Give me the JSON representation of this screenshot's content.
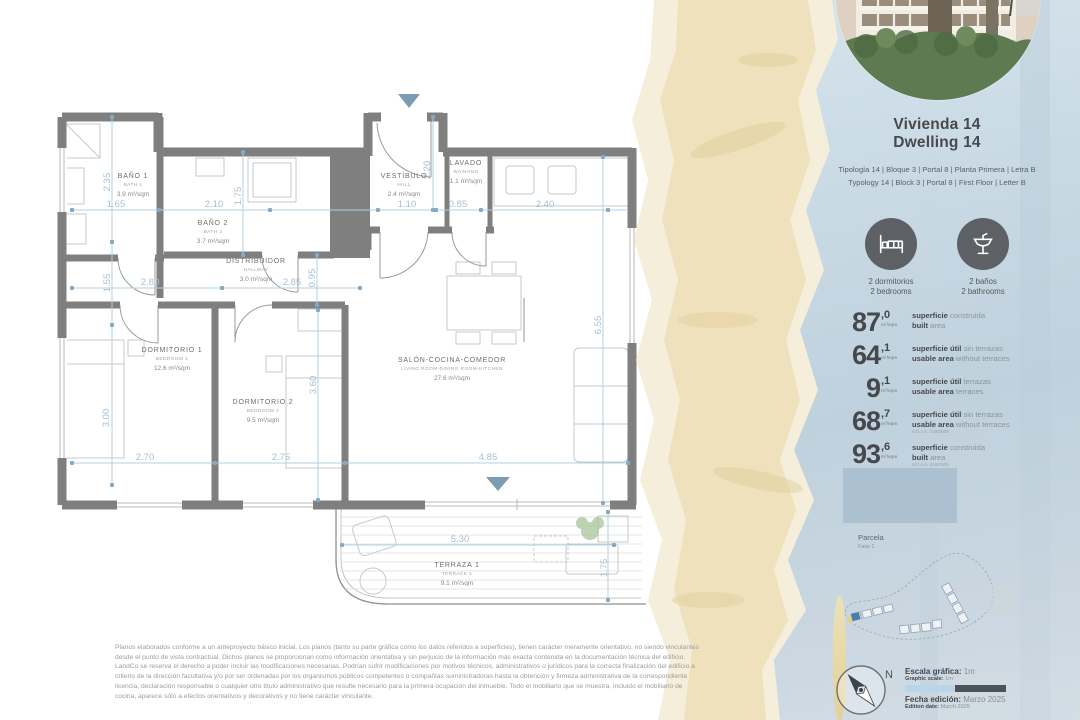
{
  "panel": {
    "title_es": "Vivienda 14",
    "title_en": "Dwelling 14",
    "typology_es": "Tipología 14  |  Bloque 3  |  Portal 8  |  Planta Primera  |  Letra B",
    "typology_en": "Typology 14  |  Block 3  |  Portal 8  |  First Floor  |  Letter B",
    "features": [
      {
        "icon": "bed-icon",
        "label_es": "2 dormitorios",
        "label_en": "2 bedrooms"
      },
      {
        "icon": "washbasin-icon",
        "label_es": "2 baños",
        "label_en": "2 bathrooms"
      }
    ],
    "stats": [
      {
        "value": "87",
        "decimal": ",0",
        "unit": "m²/sqm",
        "es_bold": "superficie",
        "es_rest": "construida",
        "en_bold": "built",
        "en_rest": "area",
        "note": ""
      },
      {
        "value": "64",
        "decimal": ",1",
        "unit": "m²/sqm",
        "es_bold": "superficie útil",
        "es_rest": "sin terrazas",
        "en_bold": "usable area",
        "en_rest": "without terraces",
        "note": ""
      },
      {
        "value": "9",
        "decimal": ",1",
        "unit": "m²/sqm",
        "es_bold": "superficie útil",
        "es_rest": "terrazas",
        "en_bold": "usable area",
        "en_rest": "terraces",
        "note": ""
      },
      {
        "value": "68",
        "decimal": ",7",
        "unit": "m²/sqm",
        "es_bold": "superficie útil",
        "es_rest": "sin terrazas",
        "en_bold": "usable area",
        "en_rest": "without terraces",
        "note": "s/O.J.A. 218/2005"
      },
      {
        "value": "93",
        "decimal": ",6",
        "unit": "m²/sqm",
        "es_bold": "superficie",
        "es_rest": "construida",
        "en_bold": "built",
        "en_rest": "area",
        "note": "s/O.J.A. 218/2005"
      }
    ],
    "parcela_label": "Parcela",
    "parcela_sub": "Fase 1",
    "compass_n": "N",
    "scale_label_es": "Escala gráfica:",
    "scale_value_es": "1m",
    "scale_label_en": "Graphic scale:",
    "scale_value_en": "1m",
    "edition_label_es": "Fecha edición:",
    "edition_value_es": "Marzo 2025",
    "edition_label_en": "Edition date:",
    "edition_value_en": "March 2025"
  },
  "plan": {
    "rooms": [
      {
        "es": "BAÑO 1",
        "en": "BATH 1",
        "area": "3.9 m²/sqm",
        "x": 133,
        "y": 178
      },
      {
        "es": "BAÑO 2",
        "en": "BATH 2",
        "area": "3.7 m²/sqm",
        "x": 213,
        "y": 225
      },
      {
        "es": "DISTRIBUIDOR",
        "en": "HALLWAY",
        "area": "3.0 m²/sqm",
        "x": 256,
        "y": 263
      },
      {
        "es": "VESTÍBULO",
        "en": "HALL",
        "area": "2.4 m²/sqm",
        "x": 404,
        "y": 178
      },
      {
        "es": "LAVADO",
        "en": "WASHING",
        "area": "1.1 m²/sqm",
        "x": 466,
        "y": 165
      },
      {
        "es": "DORMITORIO 1",
        "en": "BEDROOM 1",
        "area": "12.6 m²/sqm",
        "x": 172,
        "y": 352
      },
      {
        "es": "DORMITORIO 2",
        "en": "BEDROOM 2",
        "area": "9.5 m²/sqm",
        "x": 263,
        "y": 404
      },
      {
        "es": "SALÓN-COCINA-COMEDOR",
        "en": "LIVING ROOM-DINING ROOM-KITCHEN",
        "area": "27.6 m²/sqm",
        "x": 452,
        "y": 362
      },
      {
        "es": "TERRAZA 1",
        "en": "TERRACE 1",
        "area": "9.1 m²/sqm",
        "x": 457,
        "y": 567
      }
    ],
    "dims": [
      {
        "t": "2.35",
        "x": 110,
        "y": 182,
        "r": -90
      },
      {
        "t": "1.65",
        "x": 116,
        "y": 207
      },
      {
        "t": "2.10",
        "x": 214,
        "y": 207
      },
      {
        "t": "1.75",
        "x": 241,
        "y": 196,
        "r": -90
      },
      {
        "t": "1.10",
        "x": 407,
        "y": 207
      },
      {
        "t": "0.85",
        "x": 458,
        "y": 207
      },
      {
        "t": "2.40",
        "x": 545,
        "y": 207
      },
      {
        "t": "2.20",
        "x": 430,
        "y": 170,
        "r": -90
      },
      {
        "t": "1.55",
        "x": 110,
        "y": 283,
        "r": -90
      },
      {
        "t": "2.80",
        "x": 150,
        "y": 285
      },
      {
        "t": "2.85",
        "x": 292,
        "y": 285
      },
      {
        "t": "0.95",
        "x": 315,
        "y": 278,
        "r": -90
      },
      {
        "t": "3.00",
        "x": 109,
        "y": 418,
        "r": -90
      },
      {
        "t": "2.70",
        "x": 145,
        "y": 460
      },
      {
        "t": "2.75",
        "x": 281,
        "y": 460
      },
      {
        "t": "3.60",
        "x": 316,
        "y": 385,
        "r": -90
      },
      {
        "t": "6.55",
        "x": 601,
        "y": 325,
        "r": -90
      },
      {
        "t": "4.85",
        "x": 488,
        "y": 460
      },
      {
        "t": "5.30",
        "x": 460,
        "y": 542
      },
      {
        "t": "1.75",
        "x": 607,
        "y": 568,
        "r": -90
      }
    ]
  },
  "disclaimer": "Planos elaborados conforme a un anteproyecto básico inicial. Los planos (tanto su parte gráfica como los datos referidos a superficies), tienen carácter meramente orientativo, no siendo vinculantes desde el punto de vista contractual. Dichos planos se proporcionan como información orientativa y sin perjuicio de la información más exacta contenida en la documentación técnica del edificio. LandCo se reserva el derecho a poder incluir las modificaciones necesarias. Podrían sufrir modificaciones por motivos técnicos, administrativos o jurídicos para la correcta finalización del edificio a criterio de la dirección facultativa y/o por ser ordenadas por los organismos públicos competentes o compañías suministradoras hasta la obtención y firmeza administrativa de la correspondiente licencia, declaración responsable o cualquier otro título administrativo que resulte necesario para la primera ocupación del inmueble. Todo el mobiliario que se muestra, incluido el mobiliario de cocina, aparece sólo a efectos orientativos y decorativos y no tiene carácter vinculante."
}
